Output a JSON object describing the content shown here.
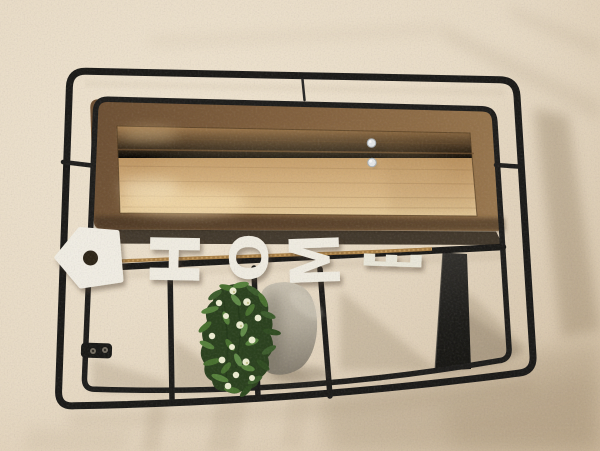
{
  "scene": {
    "type": "photograph",
    "subject": "Wall-mounted black metal wire shelf with wood-framed mirror, HOME letter garland with birdhouse on twine, and faux potted plant, photographed rotated 90 degrees on a textured beige stucco wall",
    "wall": {
      "base_color": "#ebdfcc",
      "highlight_color": "#f2e8d6",
      "shadow_color": "#c9b7a0",
      "texture": "stucco"
    },
    "frame": {
      "color": "#1a1a1a",
      "style": "double-wire rounded rectangle",
      "divider_count": 3,
      "solid_divider_color": "#1c1c1b",
      "bracket_holes": 2
    },
    "mirror": {
      "border_color": "#7b5c3d",
      "panel_color": "#cfa873",
      "panel_highlight": "#f2deb5",
      "pin_count": 2,
      "pin_color": "#e7eaed"
    },
    "sign": {
      "letters": [
        "H",
        "O",
        "M",
        "E"
      ],
      "letter_color": "#f2efe6",
      "ornament": "birdhouse",
      "ornament_color": "#f3f0e8",
      "rope_color": "#a87e45"
    },
    "plant": {
      "foliage_color": "#35522a",
      "flower_color": "#eff0d6",
      "pot_color": "#aaa294"
    }
  }
}
